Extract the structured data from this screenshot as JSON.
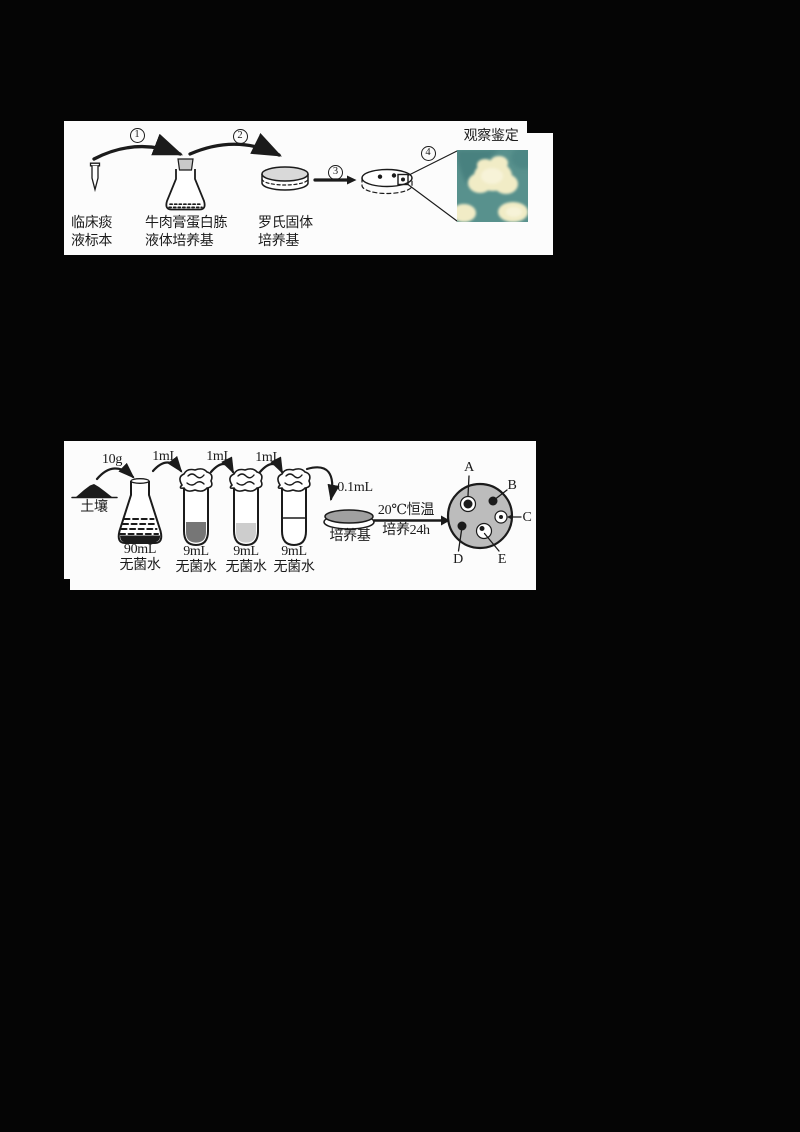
{
  "panel1": {
    "step_numbers": [
      "1",
      "2",
      "3",
      "4"
    ],
    "sample_label": [
      "临床痰",
      "液标本"
    ],
    "flask_label": [
      "牛肉膏蛋白胨",
      "液体培养基"
    ],
    "dish_label": [
      "罗氏固体",
      "培养基"
    ],
    "observe_label": "观察鉴定"
  },
  "panel2": {
    "soil_mass": "10g",
    "soil_label": "土壤",
    "flask_label": [
      "90mL",
      "无菌水"
    ],
    "transfer_labels": [
      "1mL",
      "1mL",
      "1mL"
    ],
    "tube_labels": [
      [
        "9mL",
        "无菌水"
      ],
      [
        "9mL",
        "无菌水"
      ],
      [
        "9mL",
        "无菌水"
      ]
    ],
    "plate_transfer": "0.1mL",
    "plate_label": "培养基",
    "incubation": [
      "20℃恒温",
      "培养24h"
    ],
    "colony_labels": [
      "A",
      "B",
      "C",
      "D",
      "E"
    ]
  },
  "colors": {
    "page_bg": "#050505",
    "panel_bg": "#fcfcfc",
    "ink": "#1b1b1b",
    "dish_gray_light": "#d9d9d9",
    "dish_gray_mid": "#a0a0a0",
    "plate_gray": "#bcbcbc",
    "tube1_liquid": "#767676",
    "tube2_liquid": "#cdcdcd",
    "stopper_gray": "#c9c9c9",
    "photo_teal": "#58918d",
    "photo_teal_dark": "#447e7c",
    "colony_cream": "#f1ecc6",
    "colony_cream_light": "#f7f3d8"
  }
}
